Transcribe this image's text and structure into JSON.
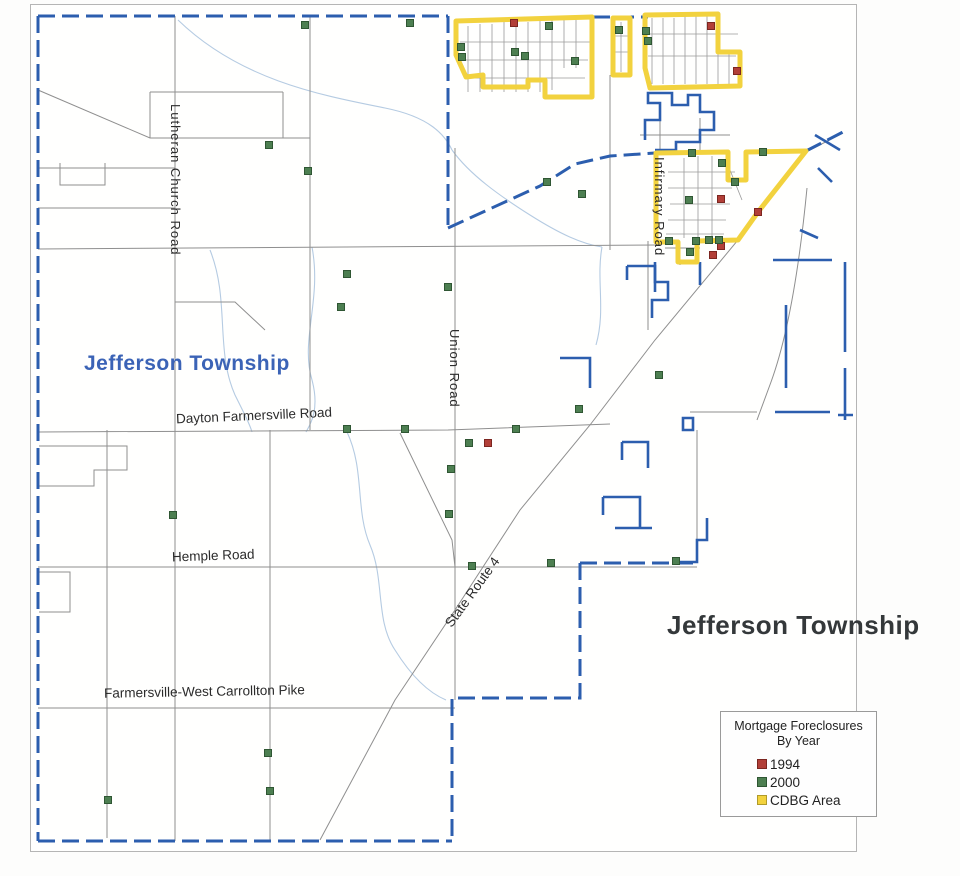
{
  "map": {
    "township_label_left": "Jefferson Township",
    "township_label_right": "Jefferson Township",
    "road_labels": {
      "lutheran": "Lutheran Church Road",
      "union": "Union Road",
      "infirmary": "Infirmary Road",
      "dayton_farmersville": "Dayton Farmersville Road",
      "hemple": "Hemple Road",
      "state_route_4": "State Route 4",
      "farmersville_west_carrollton": "Farmersville-West Carrollton Pike"
    },
    "markers": {
      "size": 7,
      "series": [
        {
          "name": "1994",
          "color": "#b23f38",
          "border": "#7c2620",
          "points": [
            [
              514,
              23
            ],
            [
              711,
              26
            ],
            [
              737,
              71
            ],
            [
              721,
              199
            ],
            [
              758,
              212
            ],
            [
              721,
              246
            ],
            [
              713,
              255
            ],
            [
              488,
              443
            ]
          ]
        },
        {
          "name": "2000",
          "color": "#4d7f51",
          "border": "#2f5633",
          "points": [
            [
              305,
              25
            ],
            [
              410,
              23
            ],
            [
              549,
              26
            ],
            [
              461,
              47
            ],
            [
              462,
              57
            ],
            [
              515,
              52
            ],
            [
              525,
              56
            ],
            [
              575,
              61
            ],
            [
              619,
              30
            ],
            [
              646,
              31
            ],
            [
              648,
              41
            ],
            [
              269,
              145
            ],
            [
              308,
              171
            ],
            [
              347,
              274
            ],
            [
              341,
              307
            ],
            [
              547,
              182
            ],
            [
              582,
              194
            ],
            [
              692,
              153
            ],
            [
              763,
              152
            ],
            [
              722,
              163
            ],
            [
              735,
              182
            ],
            [
              689,
              200
            ],
            [
              690,
              252
            ],
            [
              669,
              241
            ],
            [
              696,
              241
            ],
            [
              709,
              240
            ],
            [
              719,
              240
            ],
            [
              448,
              287
            ],
            [
              659,
              375
            ],
            [
              579,
              409
            ],
            [
              347,
              429
            ],
            [
              405,
              429
            ],
            [
              516,
              429
            ],
            [
              469,
              443
            ],
            [
              451,
              469
            ],
            [
              449,
              514
            ],
            [
              173,
              515
            ],
            [
              472,
              566
            ],
            [
              551,
              563
            ],
            [
              676,
              561
            ],
            [
              268,
              753
            ],
            [
              270,
              791
            ],
            [
              108,
              800
            ]
          ]
        }
      ]
    }
  },
  "legend": {
    "title_line1": "Mortgage Foreclosures",
    "title_line2": "By Year",
    "items": [
      {
        "label": "1994",
        "color": "#b23f38",
        "border": "#7c2620"
      },
      {
        "label": "2000",
        "color": "#4d7f51",
        "border": "#2f5633"
      },
      {
        "label": "CDBG Area",
        "color": "#f2d23e",
        "border": "#b09a2a"
      }
    ]
  },
  "colors": {
    "township_boundary": "#2c5eae",
    "cdbg_outline": "#f2d23e",
    "road_gray": "#8f8f8f",
    "stream_blue": "#b5cbe2",
    "label_blue": "#3b63b6",
    "label_black": "#34383a"
  }
}
